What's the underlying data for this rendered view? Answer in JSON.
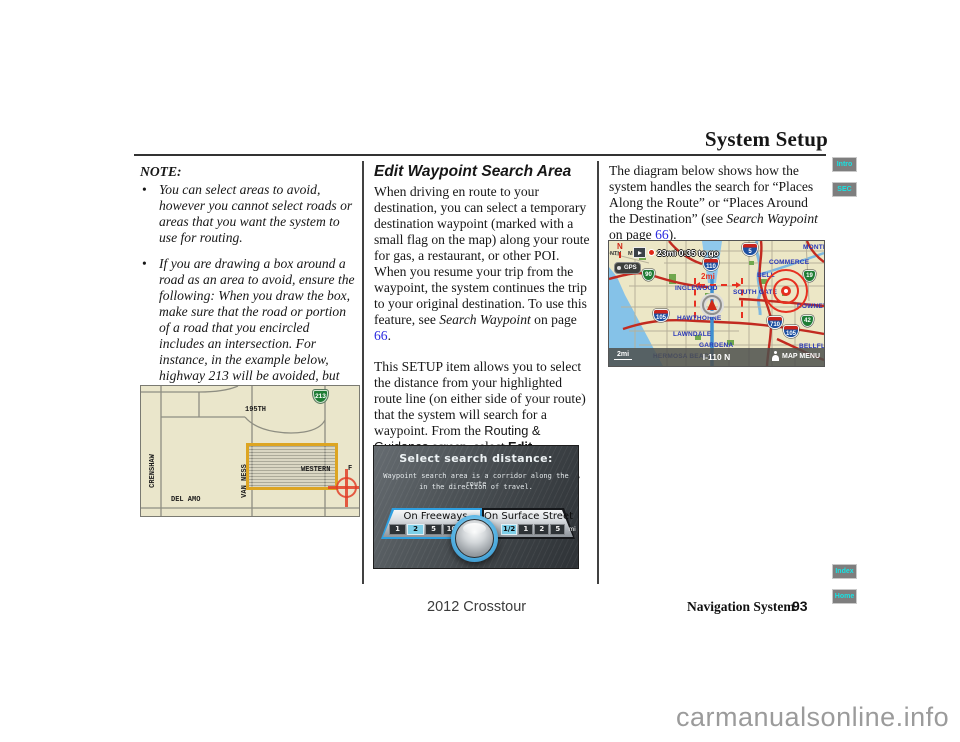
{
  "page": {
    "title": "System Setup",
    "footer_model": "2012 Crosstour",
    "footer_section": "Navigation System",
    "footer_page_number": "93",
    "watermark": "carmanualsonline.info"
  },
  "tabs": [
    {
      "label": "Intro"
    },
    {
      "label": "SEC"
    },
    {
      "label": "Index"
    },
    {
      "label": "Home"
    }
  ],
  "note": {
    "heading": "NOTE:",
    "bullets": [
      "You can select areas to avoid, however you cannot select roads or areas that you want the system to use for routing.",
      "If you are drawing a box around a road as an area to avoid, ensure the following: When you draw the box, make sure that the road or portion of a road that you encircled includes an intersection. For instance, in the example below, highway 213 will be avoided, but Van Ness will not be avoided because it lacks an intersection in the enclosed box."
    ]
  },
  "map_avoid": {
    "shield_213": "213",
    "label_195th": "195TH",
    "label_crenshaw": "CRENSHAW",
    "label_van_ness": "VAN NESS",
    "label_western": "WESTERN",
    "label_f": "F",
    "label_del_amo": "DEL AMO"
  },
  "article": {
    "heading": "Edit Waypoint Search Area",
    "p1": [
      {
        "t": "When driving en route to your destination, you can select a temporary destination waypoint (marked with a small flag on the map) along your route for gas, a restaurant, or other POI. When you resume your trip from the waypoint, the system continues the trip to your original destination. To use this feature, see "
      },
      {
        "t": "Search Waypoint"
      },
      {
        "t": " on page "
      },
      {
        "t": "66"
      },
      {
        "t": "."
      }
    ],
    "p2": [
      {
        "t": "This SETUP item allows you to select the distance from your highlighted route line (on either side of your route) that the system will search for a waypoint. From the "
      },
      {
        "t": "Routing & Guidance"
      },
      {
        "t": " screen, select "
      },
      {
        "t": "Edit Waypoint Search Area"
      },
      {
        "t": ", and then choose the desired search distance for either “On Freeways” or “On Surface Street.”"
      }
    ]
  },
  "right_col": {
    "p": [
      {
        "t": "The diagram below shows how the system handles the search for “Places Along the Route” or “Places Around the Destination” (see "
      },
      {
        "t": "Search Waypoint"
      },
      {
        "t": " on page "
      },
      {
        "t": "66"
      },
      {
        "t": ")."
      }
    ]
  },
  "select_screen": {
    "title": "Select search distance:",
    "subtitle_line1": "Waypoint search area is a corridor along the route",
    "subtitle_line2": "in the direction of travel.",
    "freeways": {
      "label": "On Freeways",
      "focused": true,
      "unit": "mi",
      "options": [
        {
          "label": "1",
          "selected": false
        },
        {
          "label": "2",
          "selected": true
        },
        {
          "label": "5",
          "selected": false
        },
        {
          "label": "10",
          "selected": false
        }
      ]
    },
    "surface": {
      "label": "On Surface Street",
      "focused": false,
      "unit": "mi",
      "options": [
        {
          "label": "1/2",
          "selected": true
        },
        {
          "label": "1",
          "selected": false
        },
        {
          "label": "2",
          "selected": false
        },
        {
          "label": "5",
          "selected": false
        }
      ]
    }
  },
  "nav_map": {
    "status_text": "23mi 0:35 to go",
    "compass": "N",
    "gps_label": "GPS",
    "corridor_width": "2mi",
    "scale_label": "2mi",
    "route_label": "I-110 N",
    "map_menu_label": "MAP MENU",
    "street_fragment_1": "NTH",
    "street_fragment_2": "ME",
    "shields": {
      "i110": "110",
      "r90": "90",
      "i5": "5",
      "r19": "19",
      "i105_west": "105",
      "i710": "710",
      "i105_east": "105",
      "r42": "42"
    },
    "cities": {
      "inglewood": "INGLEWOOD",
      "hawthorne": "HAWTHORNE",
      "lawndale": "LAWNDALE",
      "gardena": "GARDENA",
      "hermosa_beach": "HERMOSA BEACH",
      "south_gate": "SOUTH GATE",
      "bell": "BELL",
      "commerce": "COMMERCE",
      "montebello_partial": "MONTEB",
      "downey": "DOWNEY",
      "bellflower_partial": "BELLFL"
    }
  },
  "colors": {
    "link_blue": "#2b2be0",
    "tab_text_cyan": "#17e3e3",
    "selected_distance_blue": "#7ecfe8",
    "avoid_box_orange": "#dda522",
    "corridor_red": "#e83020"
  }
}
